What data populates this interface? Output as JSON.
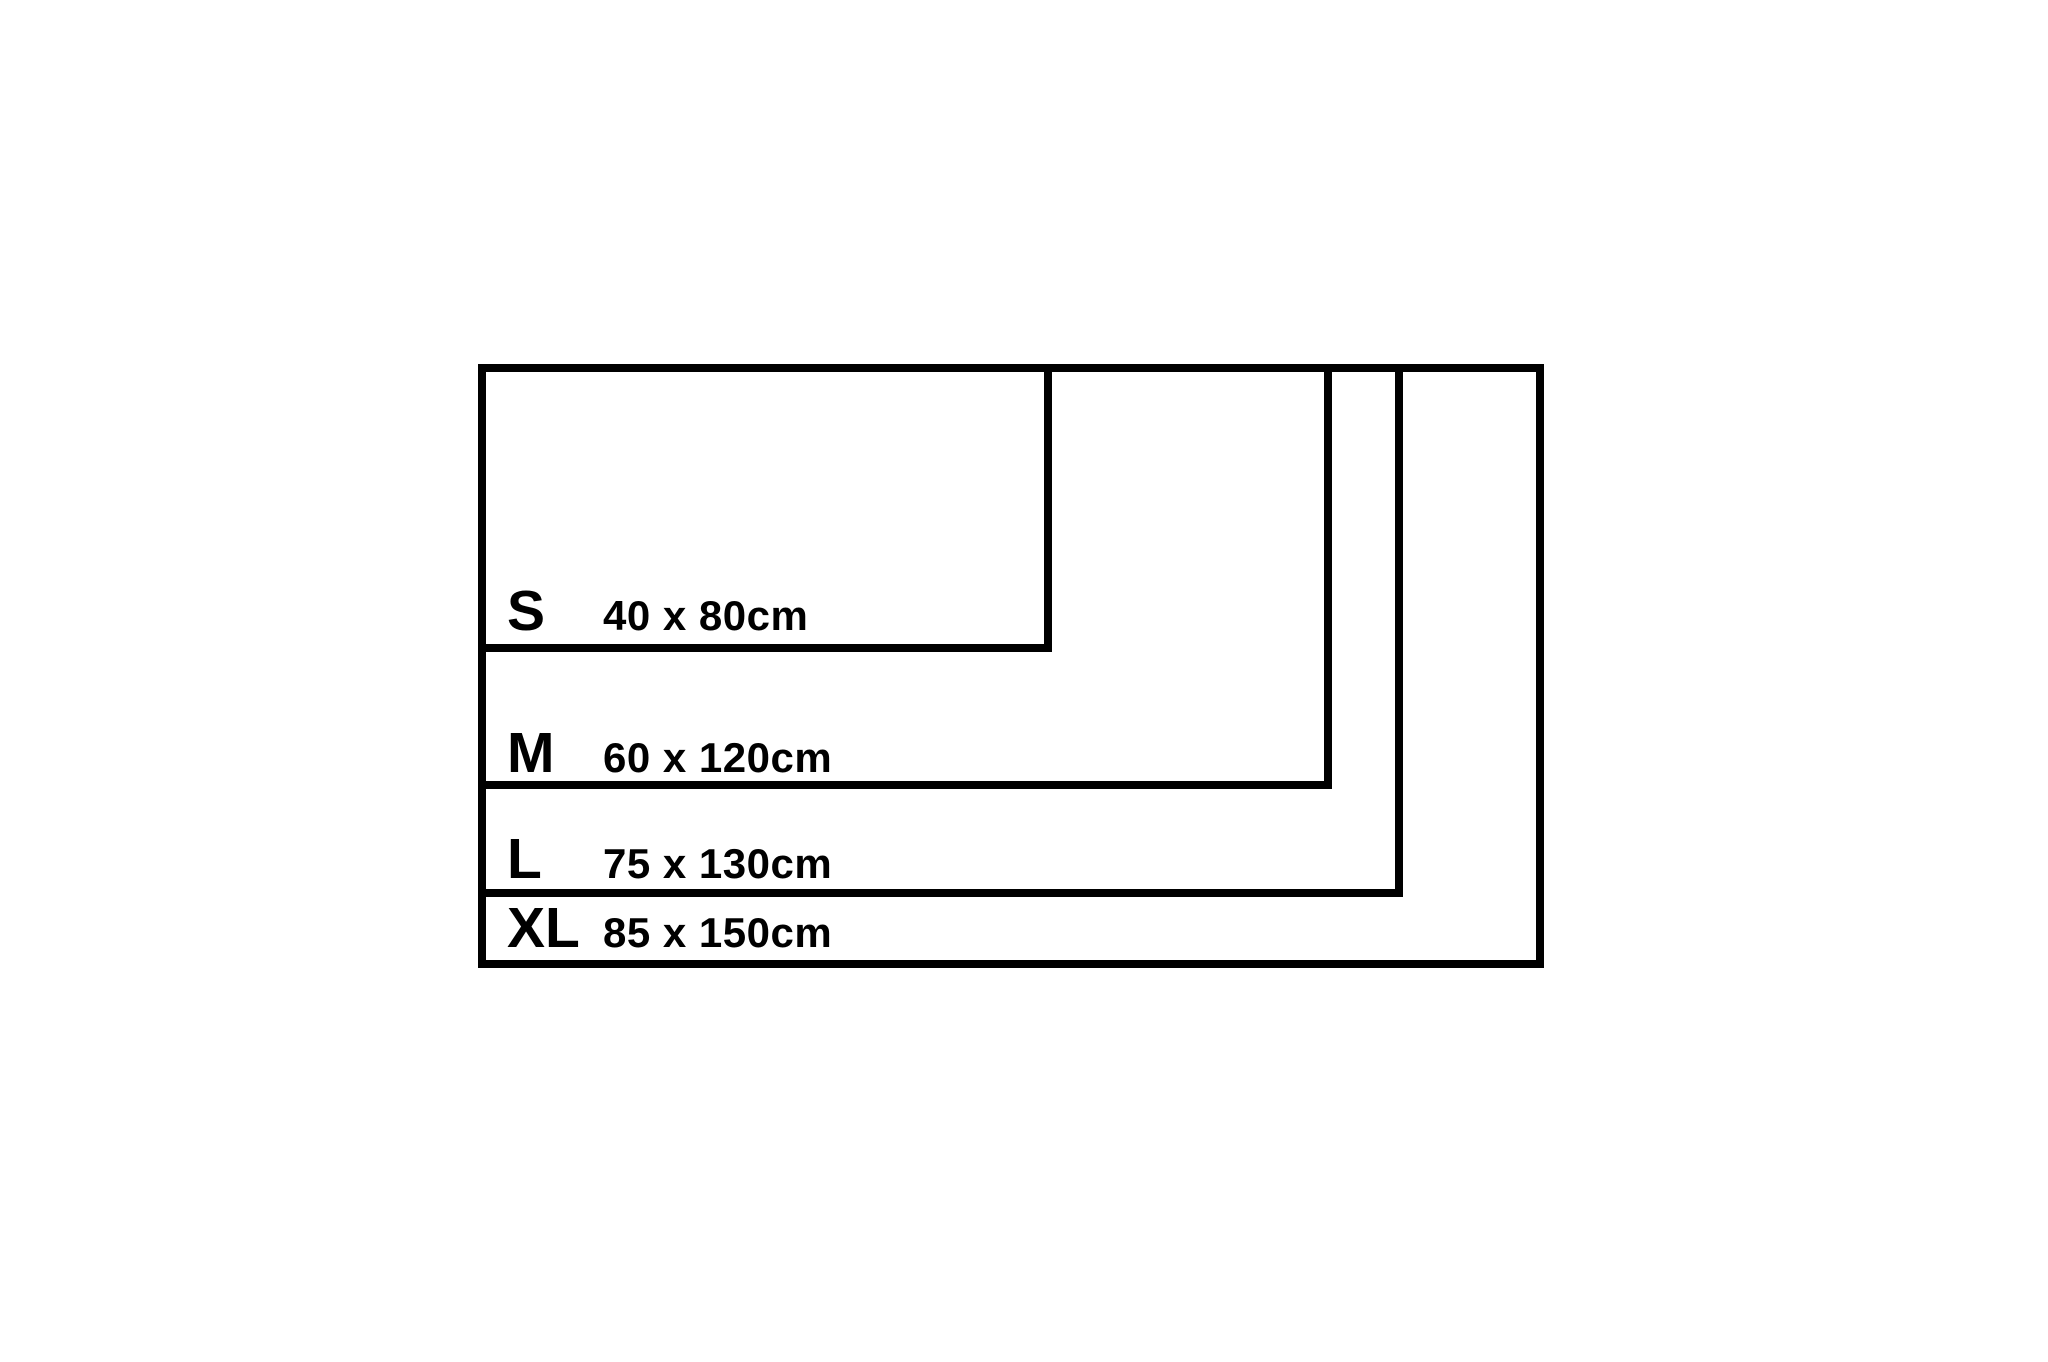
{
  "page": {
    "background": "#ffffff"
  },
  "diagram": {
    "description": "nested-rectangle size comparison chart",
    "unit": "cm",
    "line_color": "#000000",
    "sizes": [
      {
        "code": "S",
        "dimensions": "40 x 80cm",
        "width_cm": 40,
        "length_cm": 80
      },
      {
        "code": "M",
        "dimensions": "60 x 120cm",
        "width_cm": 60,
        "length_cm": 120
      },
      {
        "code": "L",
        "dimensions": "75 x 130cm",
        "width_cm": 75,
        "length_cm": 130
      },
      {
        "code": "XL",
        "dimensions": "85 x 150cm",
        "width_cm": 85,
        "length_cm": 150
      }
    ]
  }
}
